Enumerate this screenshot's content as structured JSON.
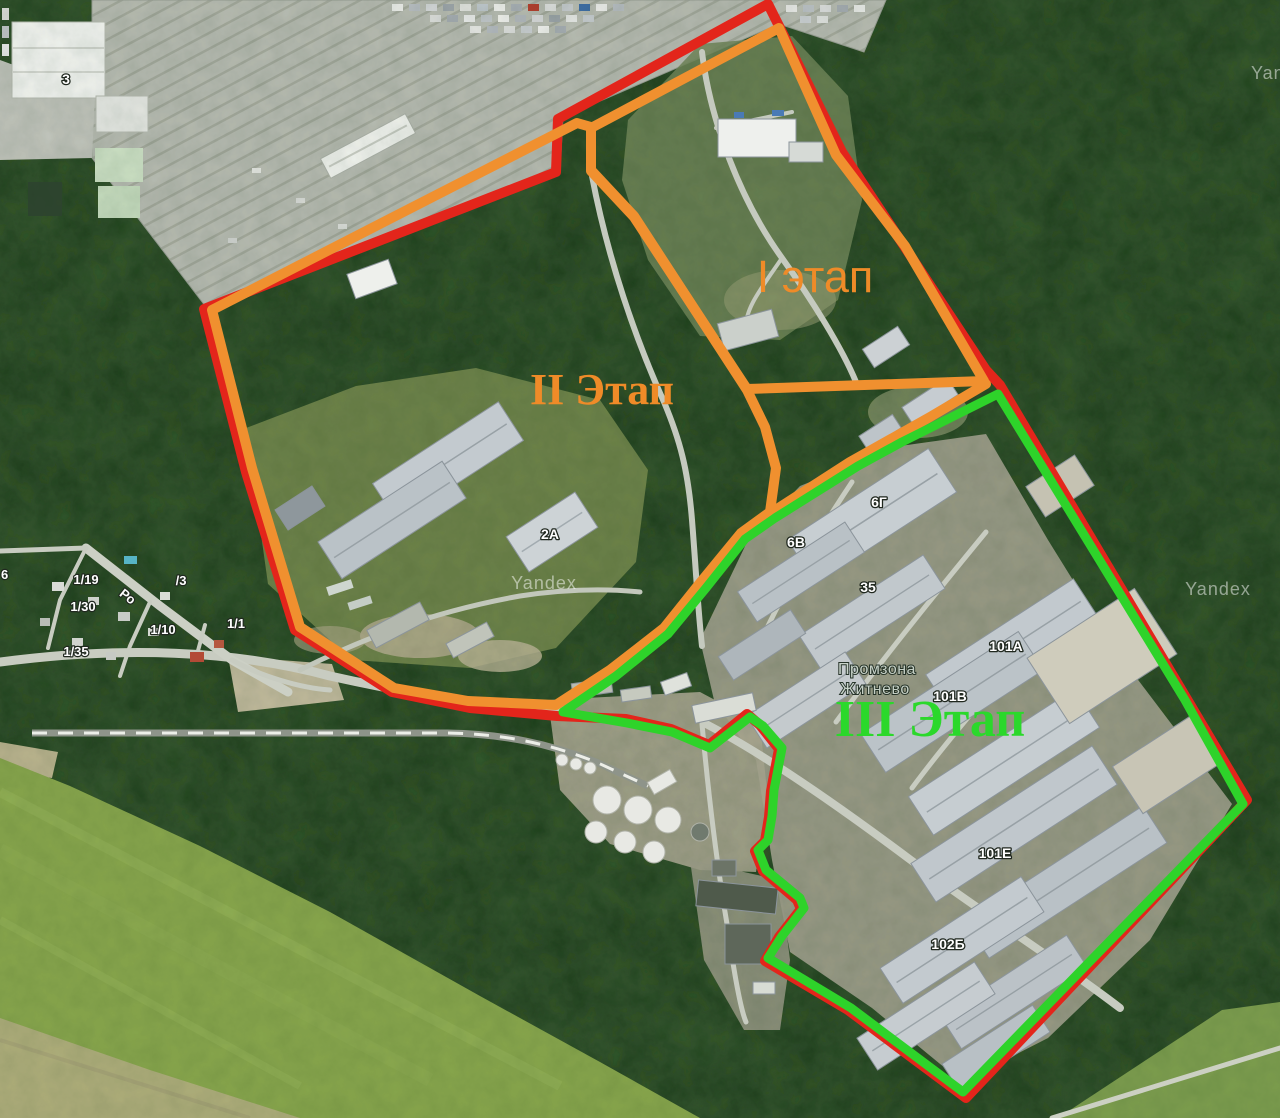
{
  "watermarks": {
    "top_right": "Yandex",
    "center": "Yandex",
    "mid_right": "Yandex"
  },
  "place": {
    "name_line1": "Промзона",
    "name_line2": "Житнево"
  },
  "phases": [
    {
      "id": "phase-1",
      "label": "I этап",
      "color": "#ef8b28"
    },
    {
      "id": "phase-2",
      "label": "II Этап",
      "color": "#ef8b28"
    },
    {
      "id": "phase-3",
      "label": "III Этап",
      "color": "#2bd82b"
    }
  ],
  "boundary_colors": {
    "outer": "#e3251b",
    "phase12": "#f0902f",
    "phase3": "#2ed32a"
  },
  "buildings": [
    {
      "text": "3"
    },
    {
      "text": "2А"
    },
    {
      "text": "6Г"
    },
    {
      "text": "6В"
    },
    {
      "text": "35"
    },
    {
      "text": "101А"
    },
    {
      "text": "101В"
    },
    {
      "text": "101Е"
    },
    {
      "text": "102Б"
    }
  ],
  "addresses": [
    {
      "text": "6"
    },
    {
      "text": "1/19"
    },
    {
      "text": "/3"
    },
    {
      "text": "1/30"
    },
    {
      "text": "1/10"
    },
    {
      "text": "1/1"
    },
    {
      "text": "1/35"
    }
  ],
  "road_label": "Ро"
}
